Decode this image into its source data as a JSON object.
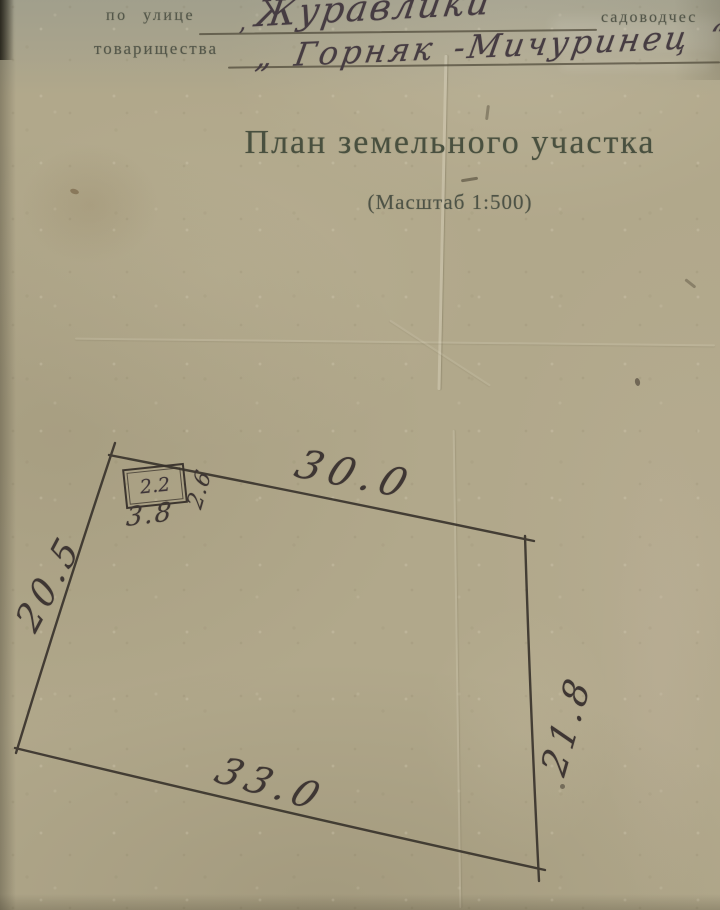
{
  "form": {
    "street_label": "по улице",
    "street_comma": ",",
    "street_value": "Журавлики",
    "right_fragment": "садоводчес",
    "society_label": "товарищества",
    "society_value": "„ Горняк -Мичуринец “"
  },
  "title": "План земельного участка",
  "scale_note": "(Масштаб 1:500)",
  "plan": {
    "top_dim": "30.0",
    "left_dim": "20.5",
    "right_dim": "21.8",
    "bottom_dim": "33.0",
    "building": {
      "label": "2.2",
      "width_dim": "3.8",
      "depth_dim": "2.6"
    }
  },
  "colors": {
    "paper": "#b1a88b",
    "ink": "#3a342d",
    "print": "#49503f"
  }
}
